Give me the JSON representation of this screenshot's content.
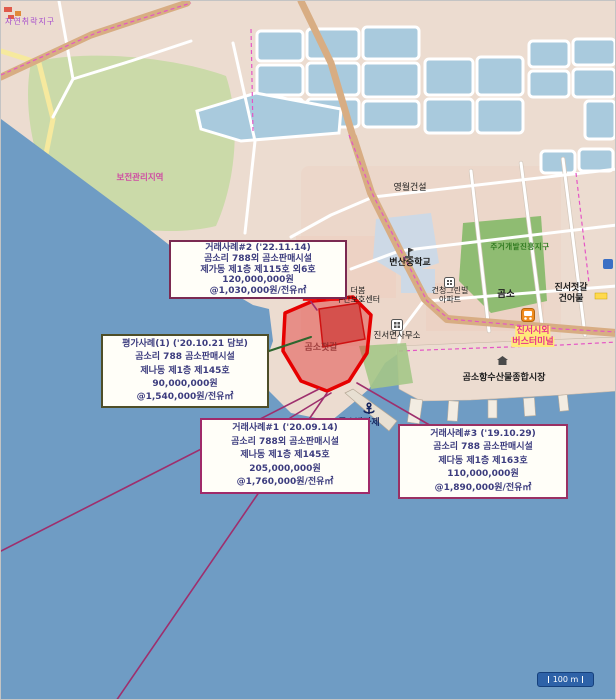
{
  "map": {
    "subject_marker": "본건",
    "subject_area_label": "곰소젓갈",
    "scale_bar_label": "100 m",
    "zones": {
      "natural_settlement": "자연취락지구",
      "conservation": "보전관리지역",
      "residential_development": "주거개발진흥지구"
    },
    "places": {
      "construction": "영월건설",
      "school": "변산중학교",
      "daycare_line1": "더봄",
      "daycare_line2": "주간보호센터",
      "apartment_line1": "건청그린빌",
      "apartment_line2": "아파트",
      "gomso": "곰소",
      "jeotgal_line1": "진서젓갈",
      "jeotgal_line2": "건어물",
      "township_office": "진서면사무소",
      "bus_terminal_line1": "진서시외",
      "bus_terminal_line2": "버스터미널",
      "fish_market": "곰소항수산물종합시장",
      "breakwater": "곰소방파제"
    },
    "callouts": [
      {
        "name": "sale-case-2",
        "lines": [
          "거래사례#2 ('22.11.14)",
          "곰소리 788외 곰소판매시설",
          "제가동 제1층 제115호 외6호",
          "120,000,000원",
          "@1,030,000원/전유㎡"
        ]
      },
      {
        "name": "appraisal-case-1",
        "lines": [
          "평가사례(1) ('20.10.21 담보)",
          "곰소리 788 곰소판매시설",
          "제나동 제1층 제145호",
          "90,000,000원",
          "@1,540,000원/전유㎡"
        ]
      },
      {
        "name": "sale-case-1",
        "lines": [
          "거래사례#1 ('20.09.14)",
          "곰소리 788외 곰소판매시설",
          "제나동 제1층 제145호",
          "205,000,000원",
          "@1,760,000원/전유㎡"
        ]
      },
      {
        "name": "sale-case-3",
        "lines": [
          "거래사례#3 ('19.10.29)",
          "곰소리 788 곰소판매시설",
          "제다동 제1층 제163호",
          "110,000,000원",
          "@1,890,000원/전유㎡"
        ]
      }
    ],
    "colors": {
      "subject_red": "#e60000",
      "sea": "#6f9cc4",
      "forest_green": "#cbdaa9",
      "zone_green": "#8fbc72",
      "pond_blue": "#a9cadd",
      "road_tan": "#d8ad83",
      "callout_text": "#3c3c7e",
      "scale_bar_bg": "#2e62a8",
      "boundary_magenta": "#e455c5"
    }
  }
}
